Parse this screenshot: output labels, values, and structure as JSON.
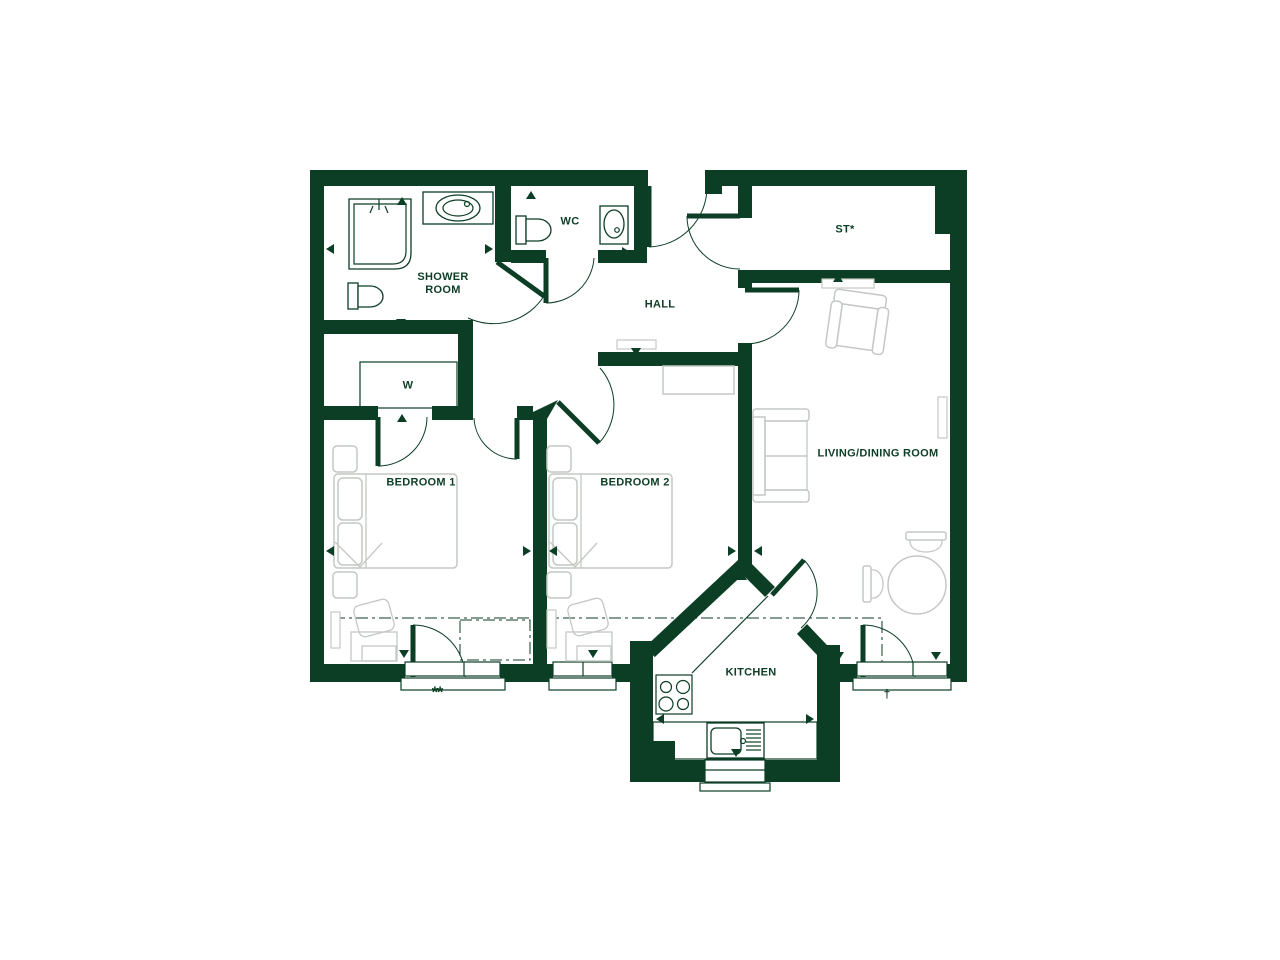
{
  "document": {
    "type": "apartment floor plan"
  },
  "theme": {
    "wall": "#0c3e25",
    "furn": "#c4c8c4",
    "paper": "#ffffff"
  },
  "rooms": {
    "shower_room": {
      "label": "SHOWER ROOM"
    },
    "wc": {
      "label": "WC"
    },
    "hall": {
      "label": "HALL"
    },
    "store": {
      "label": "ST*"
    },
    "wardrobe": {
      "label": "W"
    },
    "bedroom1": {
      "label": "BEDROOM 1"
    },
    "bedroom2": {
      "label": "BEDROOM 2"
    },
    "living_dining": {
      "label": "LIVING/DINING ROOM"
    },
    "kitchen": {
      "label": "KITCHEN"
    }
  },
  "notes": {
    "bedroom1_window": "**",
    "living_window": "†"
  }
}
